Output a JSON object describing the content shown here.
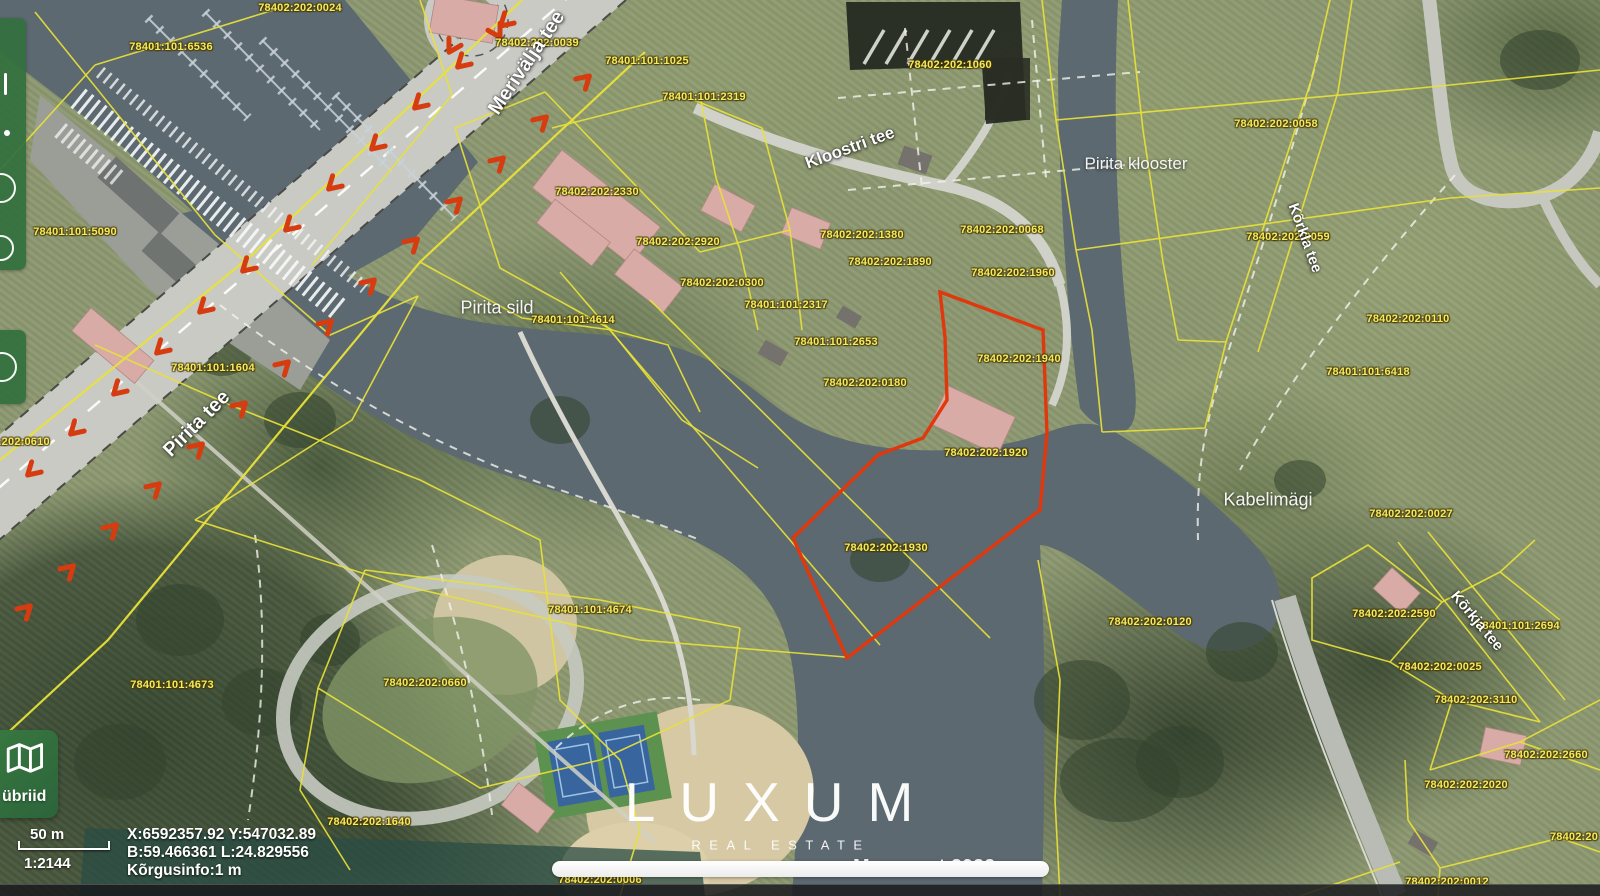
{
  "app": {
    "watermark_title": "LUXUM",
    "watermark_subtitle": "REAL ESTATE",
    "attribution": "Maa-amet 2022"
  },
  "toolbar": {
    "layer_button_label": "übriid"
  },
  "status_bar": {
    "scale_bar_label": "50 m",
    "scale_ratio": "1:2144",
    "coordinates_xy": "X:6592357.92 Y:547032.89",
    "coordinates_bl": "B:59.466361 L:24.829556",
    "elevation_info": "Kõrgusinfo:1 m"
  },
  "map": {
    "colors": {
      "cadastral_boundary": "#e8e13a",
      "highlight_parcel": "#e0380c",
      "parcel_label_text": "#f3ec5e"
    },
    "highlighted_parcels": [
      "78402:202:1940",
      "78402:202:1930"
    ],
    "parcel_labels": [
      {
        "code": "78402:202:0024",
        "x": 300,
        "y": 8
      },
      {
        "code": "78401:101:6536",
        "x": 171,
        "y": 47
      },
      {
        "code": "78402:202:0039",
        "x": 537,
        "y": 43
      },
      {
        "code": "78401:101:1025",
        "x": 647,
        "y": 61
      },
      {
        "code": "78402:202:1060",
        "x": 950,
        "y": 65
      },
      {
        "code": "78401:101:2319",
        "x": 704,
        "y": 97
      },
      {
        "code": "78402:202:0058",
        "x": 1276,
        "y": 124
      },
      {
        "code": "78402:202:2330",
        "x": 597,
        "y": 192
      },
      {
        "code": "78402:202:0068",
        "x": 1002,
        "y": 230
      },
      {
        "code": "78402:202:1380",
        "x": 862,
        "y": 235
      },
      {
        "code": "78402:202:0059",
        "x": 1288,
        "y": 237
      },
      {
        "code": "78402:202:2920",
        "x": 678,
        "y": 242
      },
      {
        "code": "78401:101:5090",
        "x": 75,
        "y": 232
      },
      {
        "code": "78402:202:1890",
        "x": 890,
        "y": 262
      },
      {
        "code": "78402:202:1960",
        "x": 1013,
        "y": 273
      },
      {
        "code": "78402:202:0300",
        "x": 722,
        "y": 283
      },
      {
        "code": "78401:101:2317",
        "x": 786,
        "y": 305
      },
      {
        "code": "78401:101:4614",
        "x": 573,
        "y": 320
      },
      {
        "code": "78402:202:0110",
        "x": 1408,
        "y": 319
      },
      {
        "code": "78401:101:1604",
        "x": 213,
        "y": 368
      },
      {
        "code": "78401:101:2653",
        "x": 836,
        "y": 342
      },
      {
        "code": "78402:202:1940",
        "x": 1019,
        "y": 359
      },
      {
        "code": "78401:101:6418",
        "x": 1368,
        "y": 372
      },
      {
        "code": "78402:202:0180",
        "x": 865,
        "y": 383
      },
      {
        "code": "78402:202:0610",
        "x": 8,
        "y": 442
      },
      {
        "code": "78402:202:1920",
        "x": 986,
        "y": 453
      },
      {
        "code": "78402:202:1930",
        "x": 886,
        "y": 548
      },
      {
        "code": "78402:202:0027",
        "x": 1411,
        "y": 514
      },
      {
        "code": "78401:101:4674",
        "x": 590,
        "y": 610
      },
      {
        "code": "78402:202:0660",
        "x": 425,
        "y": 683
      },
      {
        "code": "78401:101:4673",
        "x": 172,
        "y": 685
      },
      {
        "code": "78402:202:0120",
        "x": 1150,
        "y": 622
      },
      {
        "code": "78402:202:2590",
        "x": 1394,
        "y": 614
      },
      {
        "code": "78401:101:2694",
        "x": 1518,
        "y": 626
      },
      {
        "code": "78402:202:0025",
        "x": 1440,
        "y": 667
      },
      {
        "code": "78402:202:3110",
        "x": 1476,
        "y": 700
      },
      {
        "code": "78402:202:2660",
        "x": 1546,
        "y": 755
      },
      {
        "code": "78402:202:2020",
        "x": 1466,
        "y": 785
      },
      {
        "code": "78402:202:1640",
        "x": 369,
        "y": 822
      },
      {
        "code": "78402:20",
        "x": 1574,
        "y": 837
      },
      {
        "code": "78402:202:0006",
        "x": 600,
        "y": 880
      },
      {
        "code": "78402:202:0012",
        "x": 1447,
        "y": 882
      }
    ],
    "street_labels": [
      {
        "name": "Merivälja tee",
        "x": 527,
        "y": 63,
        "rotation": -56,
        "size": 20
      },
      {
        "name": "Kloostri tee",
        "x": 850,
        "y": 148,
        "rotation": -20,
        "size": 17
      },
      {
        "name": "Pirita tee",
        "x": 197,
        "y": 424,
        "rotation": -45,
        "size": 20
      },
      {
        "name": "Kõrkla tee",
        "x": 1305,
        "y": 238,
        "rotation": 70,
        "size": 15
      },
      {
        "name": "Kõrkja tee",
        "x": 1477,
        "y": 621,
        "rotation": 50,
        "size": 15
      }
    ],
    "place_labels": [
      {
        "name": "Pirita klooster",
        "x": 1136,
        "y": 164,
        "size": 17
      },
      {
        "name": "Pirita sild",
        "x": 497,
        "y": 308,
        "size": 18
      },
      {
        "name": "Kabelimägi",
        "x": 1268,
        "y": 500,
        "size": 18
      }
    ]
  }
}
